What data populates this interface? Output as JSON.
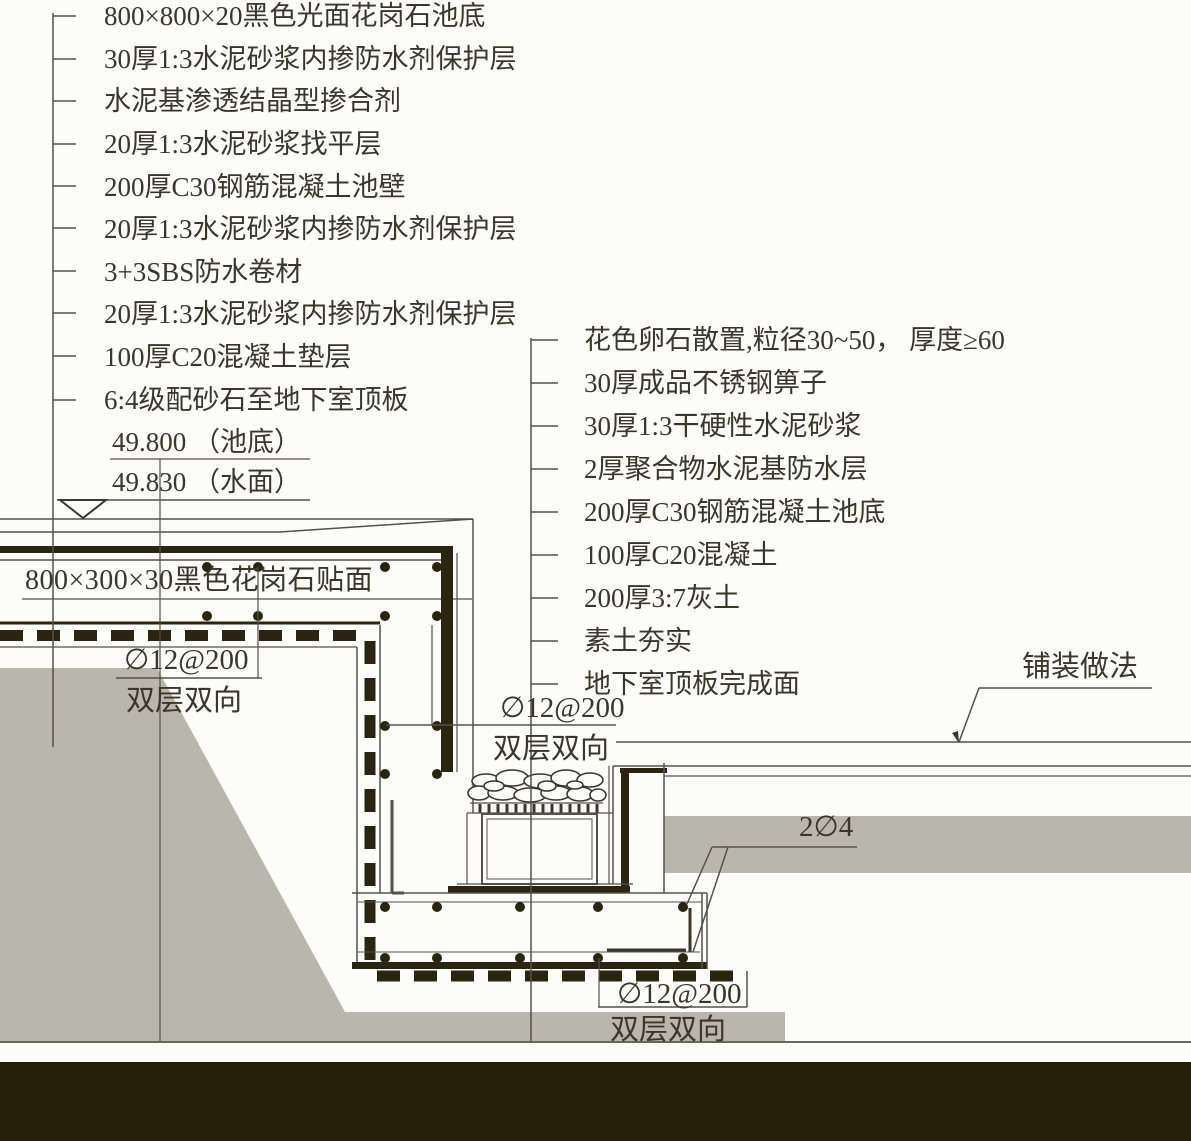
{
  "title": "水池与排水沟构造详图",
  "left_callouts": [
    "800×800×20黑色光面花岗石池底",
    "30厚1:3水泥砂浆内掺防水剂保护层",
    "水泥基渗透结晶型掺合剂",
    "20厚1:3水泥砂浆找平层",
    "200厚C30钢筋混凝土池壁",
    "20厚1:3水泥砂浆内掺防水剂保护层",
    "3+3SBS防水卷材",
    "20厚1:3水泥砂浆内掺防水剂保护层",
    "100厚C20混凝土垫层",
    "6:4级配砂石至地下室顶板"
  ],
  "levels": {
    "pool_bottom": "49.800 （池底）",
    "water_surface": "49.830 （水面）"
  },
  "right_callouts": [
    "花色卵石散置,粒径30~50， 厚度≥60",
    "30厚成品不锈钢箅子",
    "30厚1:3干硬性水泥砂浆",
    "2厚聚合物水泥基防水层",
    "200厚C30钢筋混凝土池底",
    "100厚C20混凝土",
    "200厚3:7灰土",
    "素土夯实",
    "地下室顶板完成面"
  ],
  "granite_facing": "800×300×30黑色花岗石贴面",
  "rebar": {
    "spec": "∅12@200",
    "note": "双层双向"
  },
  "edge_bars": "2∅4",
  "paving_note": "铺装做法",
  "colors": {
    "line": "#55514a",
    "dark": "#2a2410",
    "soil_gray": "#b9b6ab",
    "bottom_band": "#262008",
    "text": "#3a362a"
  }
}
